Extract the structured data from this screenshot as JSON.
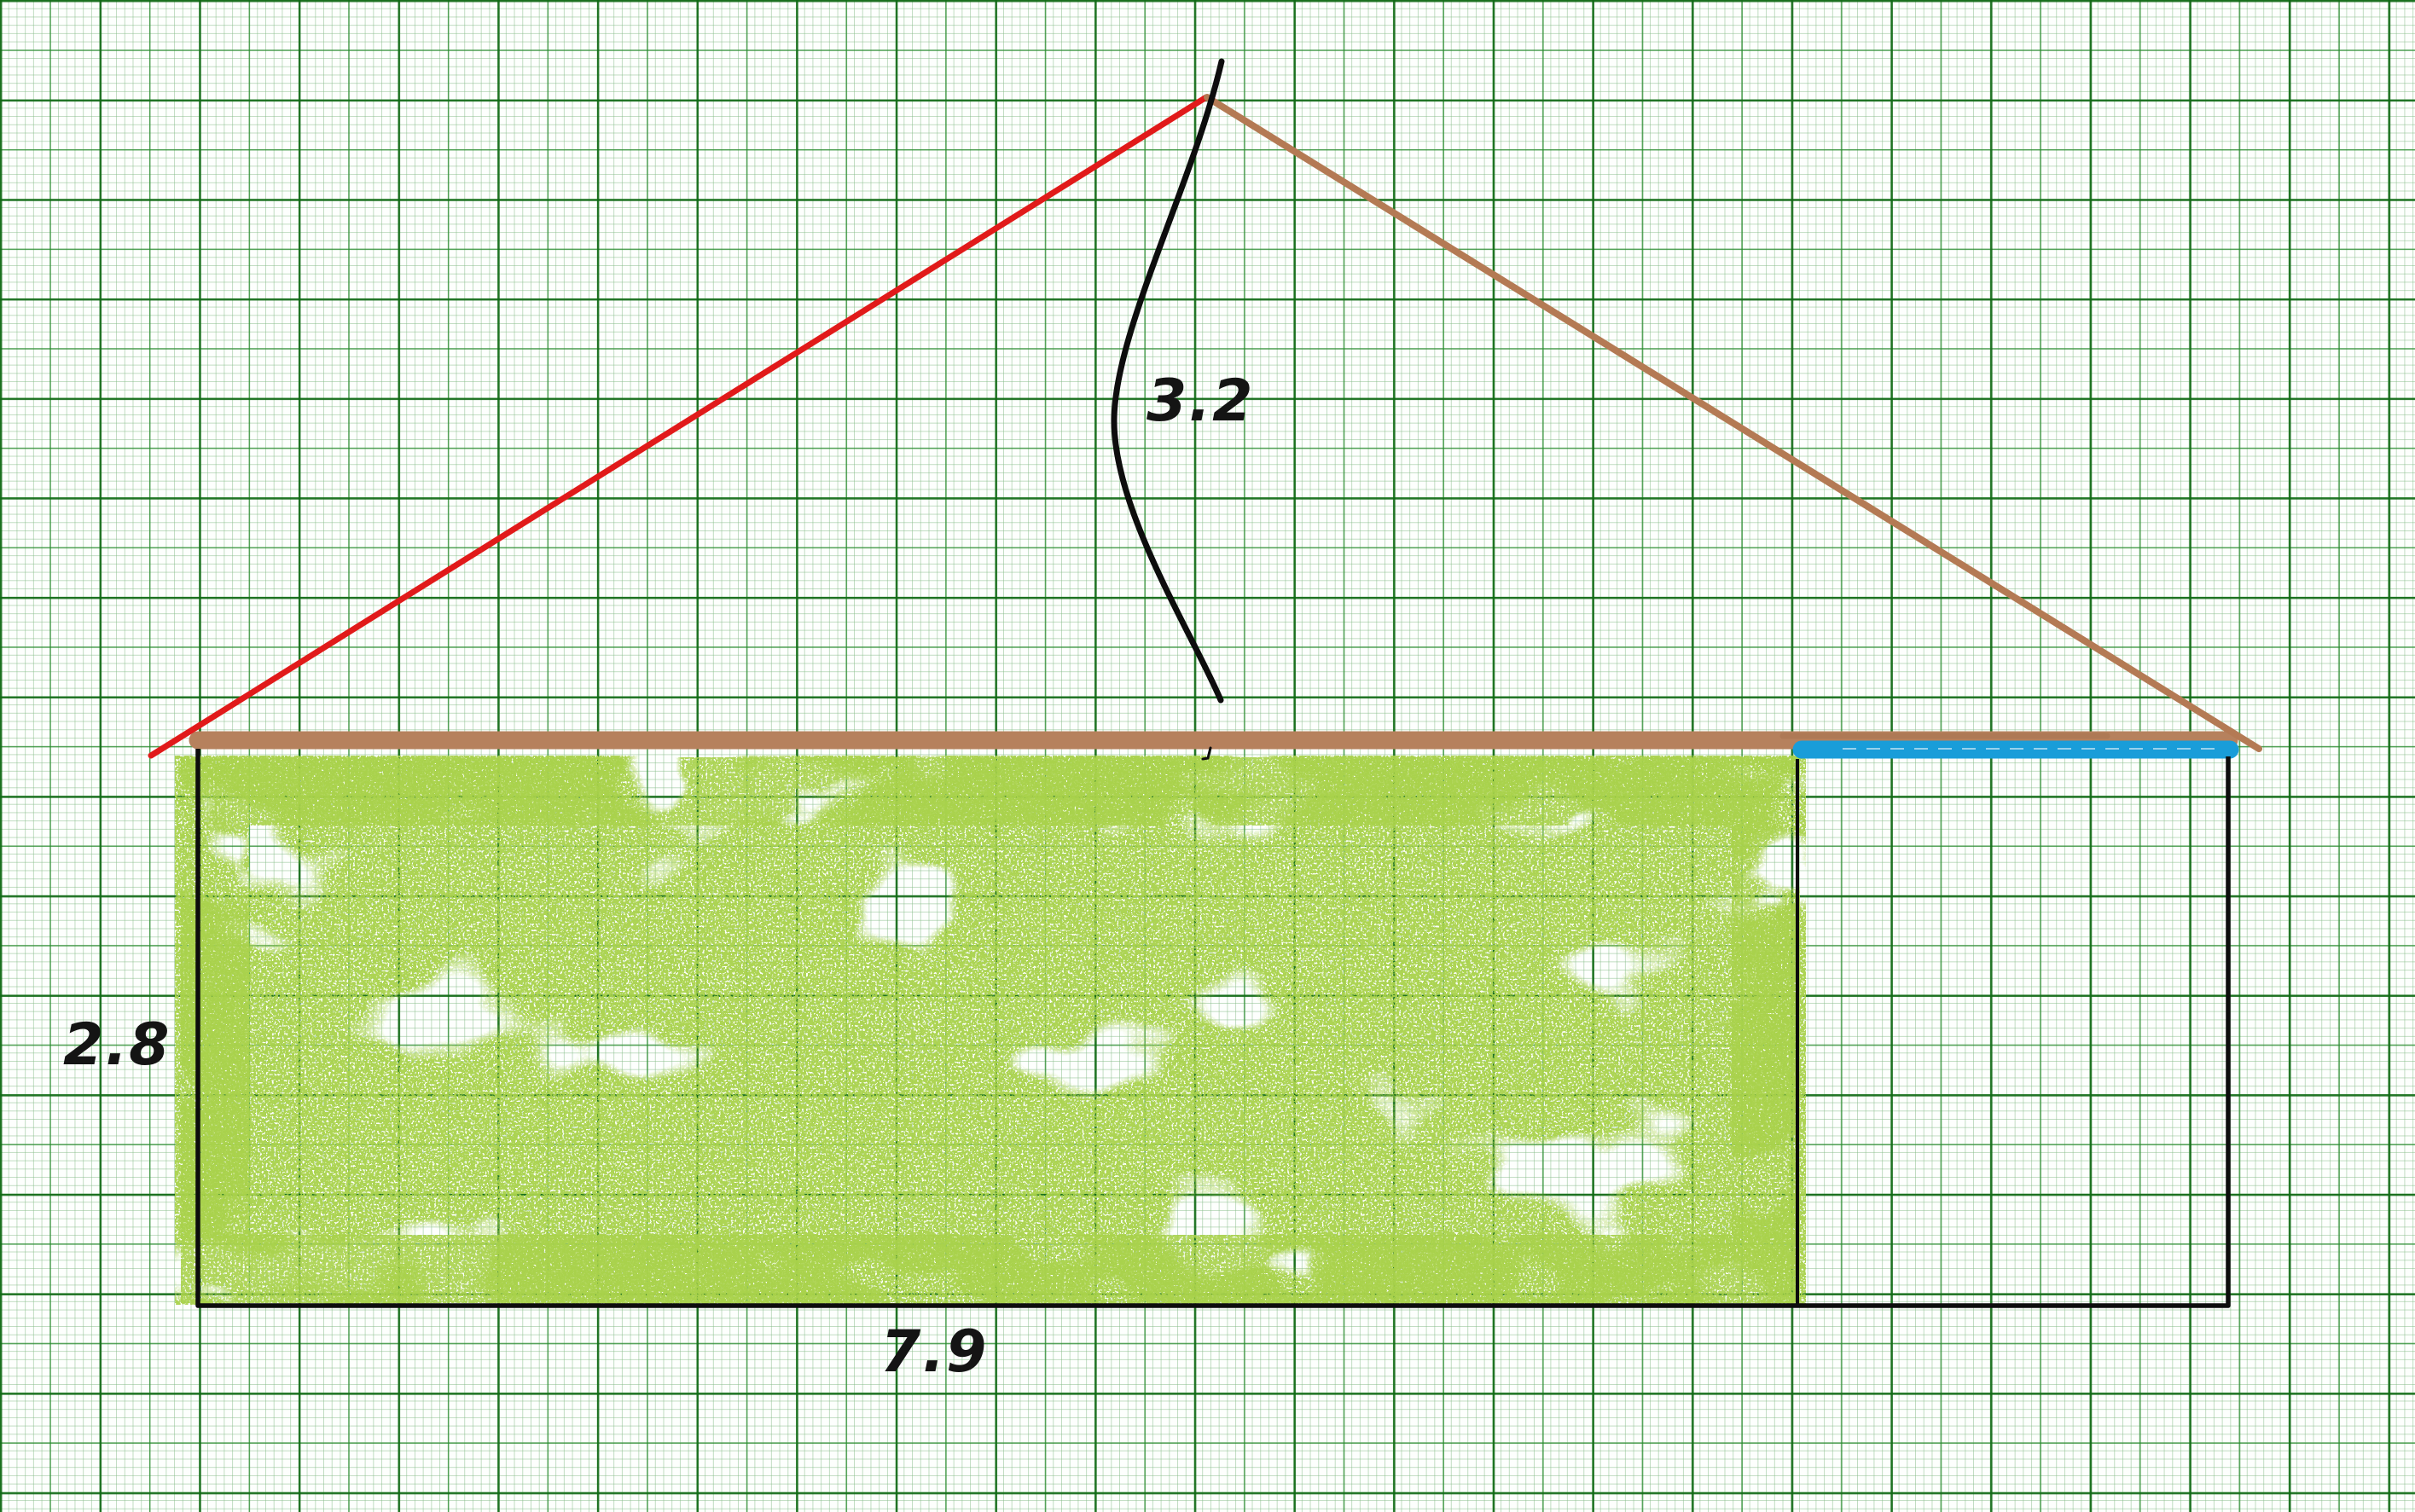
{
  "diagram": {
    "type": "house-cross-section-sketch-on-graph-paper",
    "labels": {
      "roof_height": "3.2",
      "wall_height": "2.8",
      "width": "7.9"
    },
    "colors": {
      "red_roof_line": "#e11a1a",
      "brown_roof_line": "#b47a54",
      "brown_beam": "#b6815d",
      "blue_marker": "#199dd9",
      "green_spray": "#a9d24b",
      "ink_black": "#0d0d0d",
      "grid_major": "#268a2c",
      "grid_fine": "#82b984",
      "paper": "#fdfffd"
    }
  }
}
